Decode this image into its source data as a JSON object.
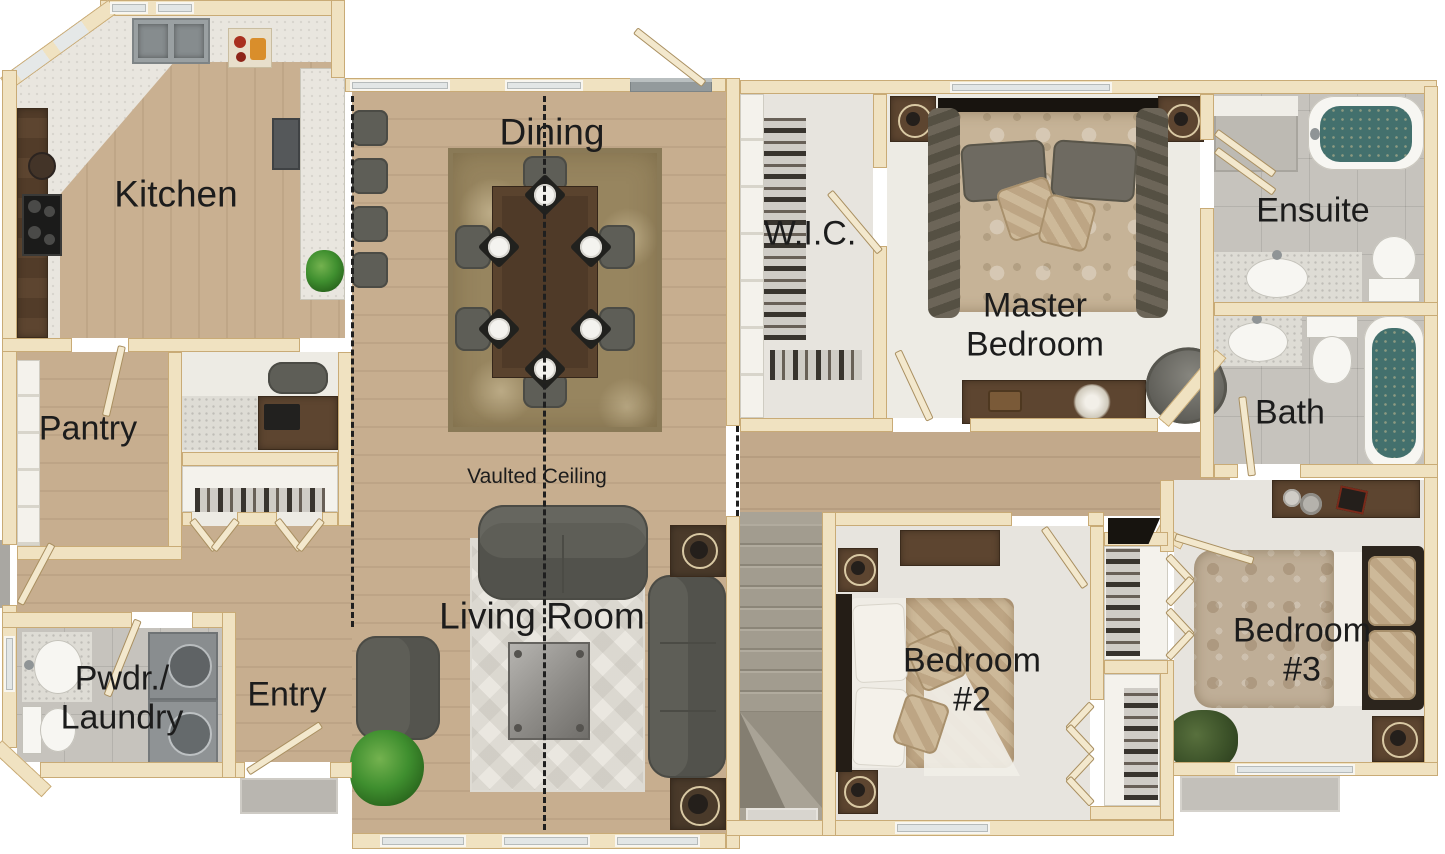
{
  "type": "floor-plan",
  "title": "Single-storey 3-bedroom house floor plan",
  "rooms": [
    {
      "name": "kitchen",
      "lines": [
        "Kitchen"
      ]
    },
    {
      "name": "dining",
      "lines": [
        "Dining"
      ]
    },
    {
      "name": "pantry",
      "lines": [
        "Pantry"
      ]
    },
    {
      "name": "wic",
      "lines": [
        "W.I.C."
      ]
    },
    {
      "name": "master-bedroom",
      "lines": [
        "Master",
        "Bedroom"
      ]
    },
    {
      "name": "ensuite",
      "lines": [
        "Ensuite"
      ]
    },
    {
      "name": "bath",
      "lines": [
        "Bath"
      ]
    },
    {
      "name": "living-room",
      "lines": [
        "Living Room"
      ]
    },
    {
      "name": "vaulted-ceiling",
      "lines": [
        "Vaulted Ceiling"
      ]
    },
    {
      "name": "pwdr-laundry",
      "lines": [
        "Pwdr./",
        "Laundry"
      ]
    },
    {
      "name": "entry",
      "lines": [
        "Entry"
      ]
    },
    {
      "name": "bedroom-2",
      "lines": [
        "Bedroom",
        "#2"
      ]
    },
    {
      "name": "bedroom-3",
      "lines": [
        "Bedroom",
        "#3"
      ]
    }
  ],
  "colors": {
    "wall": "#f0e2c1",
    "wallEdge": "#c9ab76",
    "woodFloor": "#c7ae8f",
    "carpet": "#e7e4de",
    "tile": "#c6c3bd",
    "counterSpeckle": "#dedcd5",
    "tubWater": "#43706d",
    "furnitureGray": "#5e5e57",
    "furnitureWood": "#5d4530",
    "rugBrown": "#97855f",
    "rugLight": "#eae7e0",
    "labelText": "#1c1c1c",
    "background": "#ffffff"
  }
}
